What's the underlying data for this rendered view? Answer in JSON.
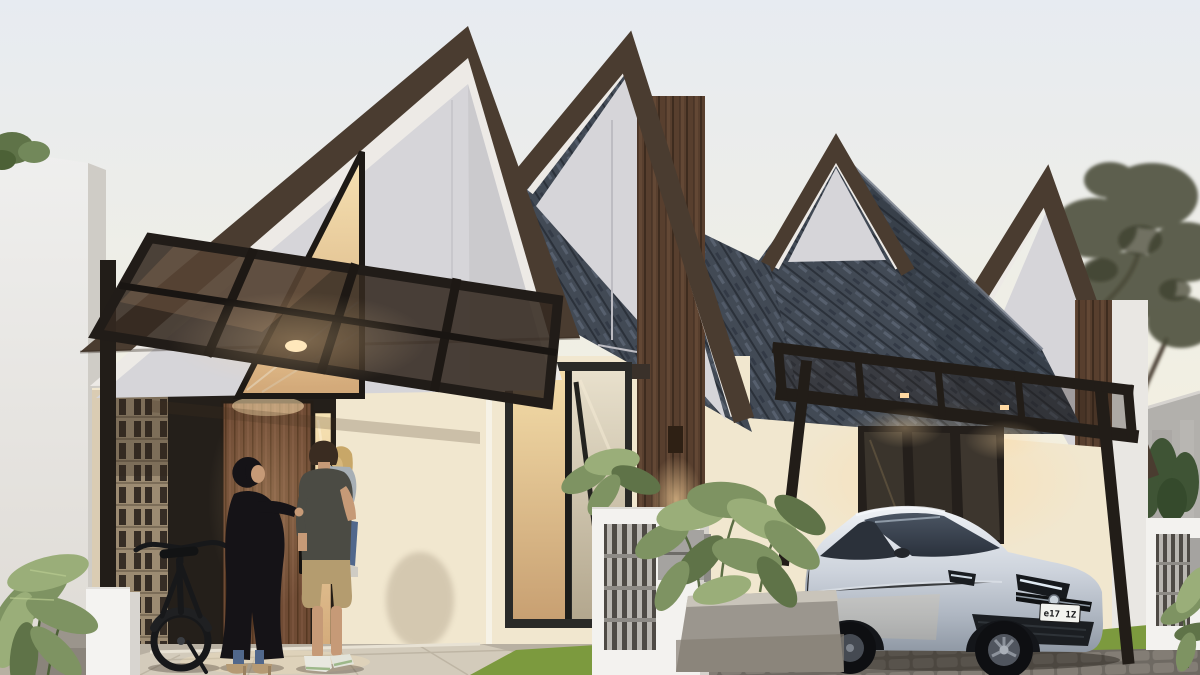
{
  "meta": {
    "description": "3D architectural exterior rendering of a row of modern minimalist gable houses at dusk",
    "image_type": "architectural render",
    "houses_visible": 4
  },
  "colors": {
    "sky_top": "#e7ebf1",
    "sky_mid": "#f1efe3",
    "sky_horizon": "#f8f2db",
    "trim_brown": "#4a3c30",
    "fascia_white": "#edeae6",
    "gable_gray": "#d6d5d9",
    "wall_cream": "#f1e7cf",
    "wall_lit": "#fbeed2",
    "wood_dark": "#583f2e",
    "door_wood": "#6f4b34",
    "shingle": "#424a55",
    "shingle_dark": "#2b313a",
    "shingle_light": "#5b6472",
    "steel_dark": "#221d18",
    "canopy_glass": "#342920",
    "breeze_tan": "#9c8b72",
    "breeze_dark": "#362d25",
    "car_silver": "#c7cdd7",
    "car_glass": "#39414d",
    "plant_green": "#7e9362",
    "plant_light": "#9aae79",
    "plant_dark": "#5f7348",
    "grass_green": "#7c9a3e",
    "paving_light": "#d3cbbb",
    "paving_mid": "#b8b0a2",
    "cobble": "#76716a",
    "concrete": "#b2b0ac",
    "fence_white": "#f3f2ef",
    "grille_gray": "#8f8d89",
    "mailbox_gray": "#a5a3a0",
    "warm_light": "#ffd9a0",
    "tree_olive": "#4b4c3a",
    "skin": "#c69a77",
    "denim": "#51688c",
    "khaki": "#b49c6f",
    "tee": "#4b4b44",
    "abaya": "#151317",
    "hair_brown": "#3a2c21",
    "hair_blonde": "#d8b87c",
    "heel_tan": "#b59a74"
  },
  "scene": {
    "sky": {
      "condition": "clear pale dusk sky"
    },
    "houses": {
      "style": "modern gable houses with thick dark-brown roof trim and white fascia",
      "roof": "dark slate shingles",
      "walls": "cream render with light-gray gable panels and vertical dark wood siding",
      "lighting": "warm wall sconces and downlights glowing"
    },
    "entrance": {
      "canopy": "tinted glass on black steel frame",
      "door": "wood panel front door with black handle",
      "sidelight": "warm lit glass strip",
      "screen": "breeze-block lattice panel",
      "gable_window": "triangular black-framed window"
    },
    "car": {
      "type": "silver hatchback parked under black steel carport",
      "license_plate": "e17 1Z"
    },
    "people": [
      {
        "id": "woman",
        "description": "woman in black hijab and abaya, jeans and heels"
      },
      {
        "id": "man",
        "description": "man in dark t-shirt and khaki shorts seen from behind"
      },
      {
        "id": "child",
        "description": "blonde child in jeans carried on the man's arm"
      }
    ],
    "objects": [
      "black bicycle",
      "white gate pillar",
      "fence pillars with slat grilles and gray mailboxes",
      "tropical potted plants",
      "concrete planter",
      "tree silhouette",
      "concrete boundary wall",
      "conifer shrubs",
      "lawn strips",
      "stone paving and cobbled driveway"
    ]
  }
}
